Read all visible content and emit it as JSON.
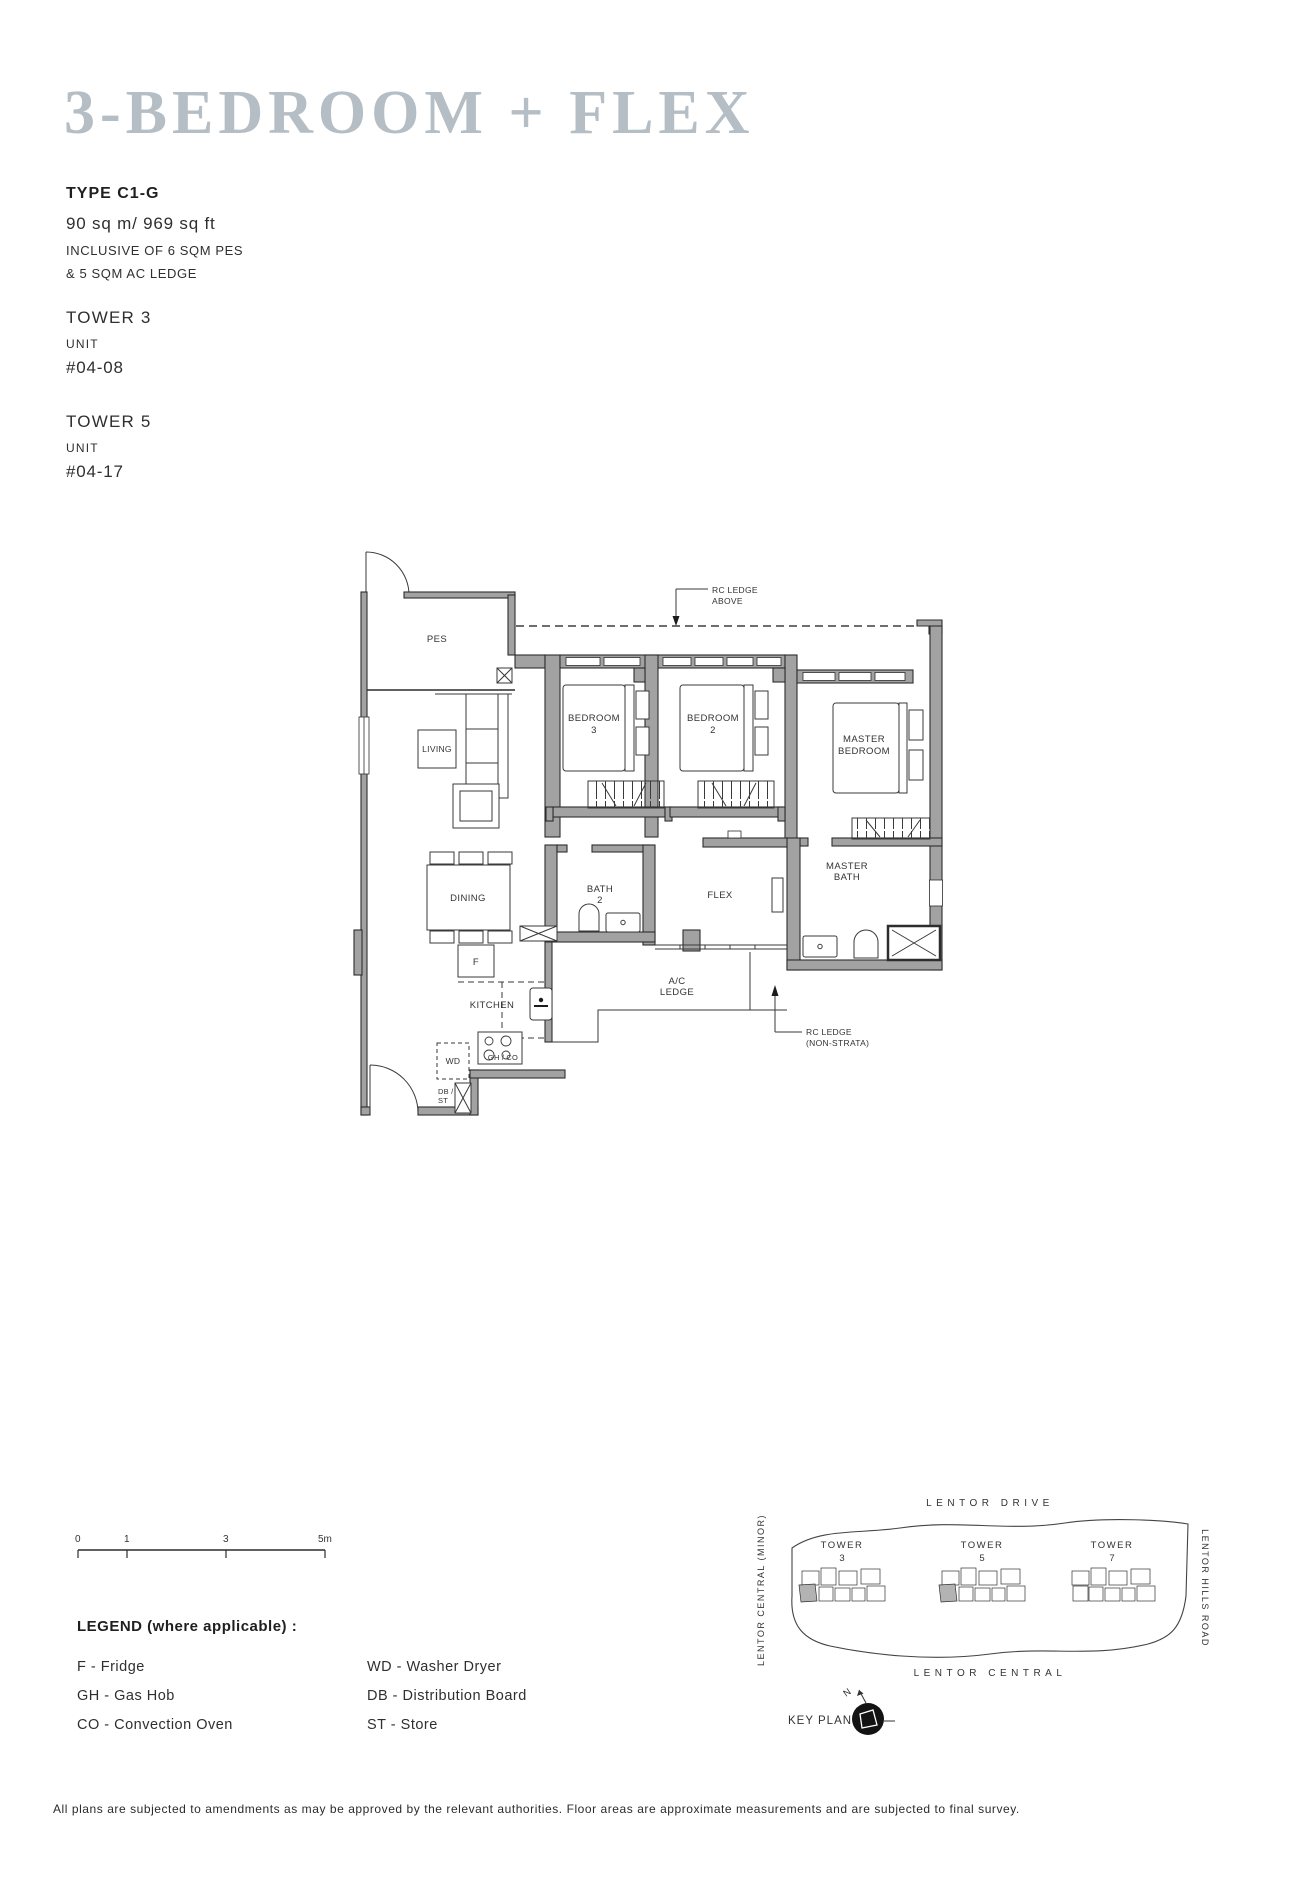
{
  "header": {
    "title": "3-BEDROOM + FLEX",
    "type": "TYPE C1-G",
    "area": "90 sq m/ 969 sq ft",
    "note1": "INCLUSIVE OF 6 SQM PES",
    "note2": "& 5 SQM AC LEDGE",
    "towers": [
      {
        "name": "TOWER 3",
        "unit_label": "UNIT",
        "unit_no": "#04-08"
      },
      {
        "name": "TOWER 5",
        "unit_label": "UNIT",
        "unit_no": "#04-17"
      }
    ]
  },
  "plan": {
    "labels": {
      "pes": "PES",
      "living": "LIVING",
      "dining": "DINING",
      "kitchen": "KITCHEN",
      "flex": "FLEX",
      "bedroom3": [
        "BEDROOM",
        "3"
      ],
      "bedroom2": [
        "BEDROOM",
        "2"
      ],
      "master_bedroom": [
        "MASTER",
        "BEDROOM"
      ],
      "bath2": [
        "BATH",
        "2"
      ],
      "master_bath": [
        "MASTER",
        "BATH"
      ],
      "ac_ledge": [
        "A/C",
        "LEDGE"
      ],
      "rc_ledge_above": [
        "RC LEDGE",
        "ABOVE"
      ],
      "rc_ledge_non_strata": [
        "RC LEDGE",
        "(NON-STRATA)"
      ],
      "fridge": "F",
      "washer_dryer": "WD",
      "gas_hob_oven": "GH / CO",
      "db": "DB /",
      "st": "ST"
    }
  },
  "scalebar": {
    "t0": "0",
    "t1": "1",
    "t3": "3",
    "t5": "5m"
  },
  "legend": {
    "heading": "LEGEND (where applicable) :",
    "items_left": [
      "F - Fridge",
      "GH - Gas Hob",
      "CO - Convection Oven"
    ],
    "items_right": [
      "WD - Washer Dryer",
      "DB - Distribution Board",
      "ST - Store"
    ]
  },
  "keyplan": {
    "road_top": "LENTOR DRIVE",
    "road_bottom": "LENTOR CENTRAL",
    "road_left": "LENTOR CENTRAL (MINOR)",
    "road_right": "LENTOR HILLS ROAD",
    "towers": [
      {
        "label": "TOWER",
        "no": "3"
      },
      {
        "label": "TOWER",
        "no": "5"
      },
      {
        "label": "TOWER",
        "no": "7"
      }
    ],
    "title": "KEY PLAN",
    "north": "N"
  },
  "footer": "All plans are subjected to amendments as may be approved by the relevant authorities. Floor areas are approximate measurements and are subjected to final survey.",
  "colors": {
    "title": "#b5bec4",
    "wall": "#a2a2a2",
    "line": "#2d2d2d",
    "highlight": "#b3b3b3"
  }
}
